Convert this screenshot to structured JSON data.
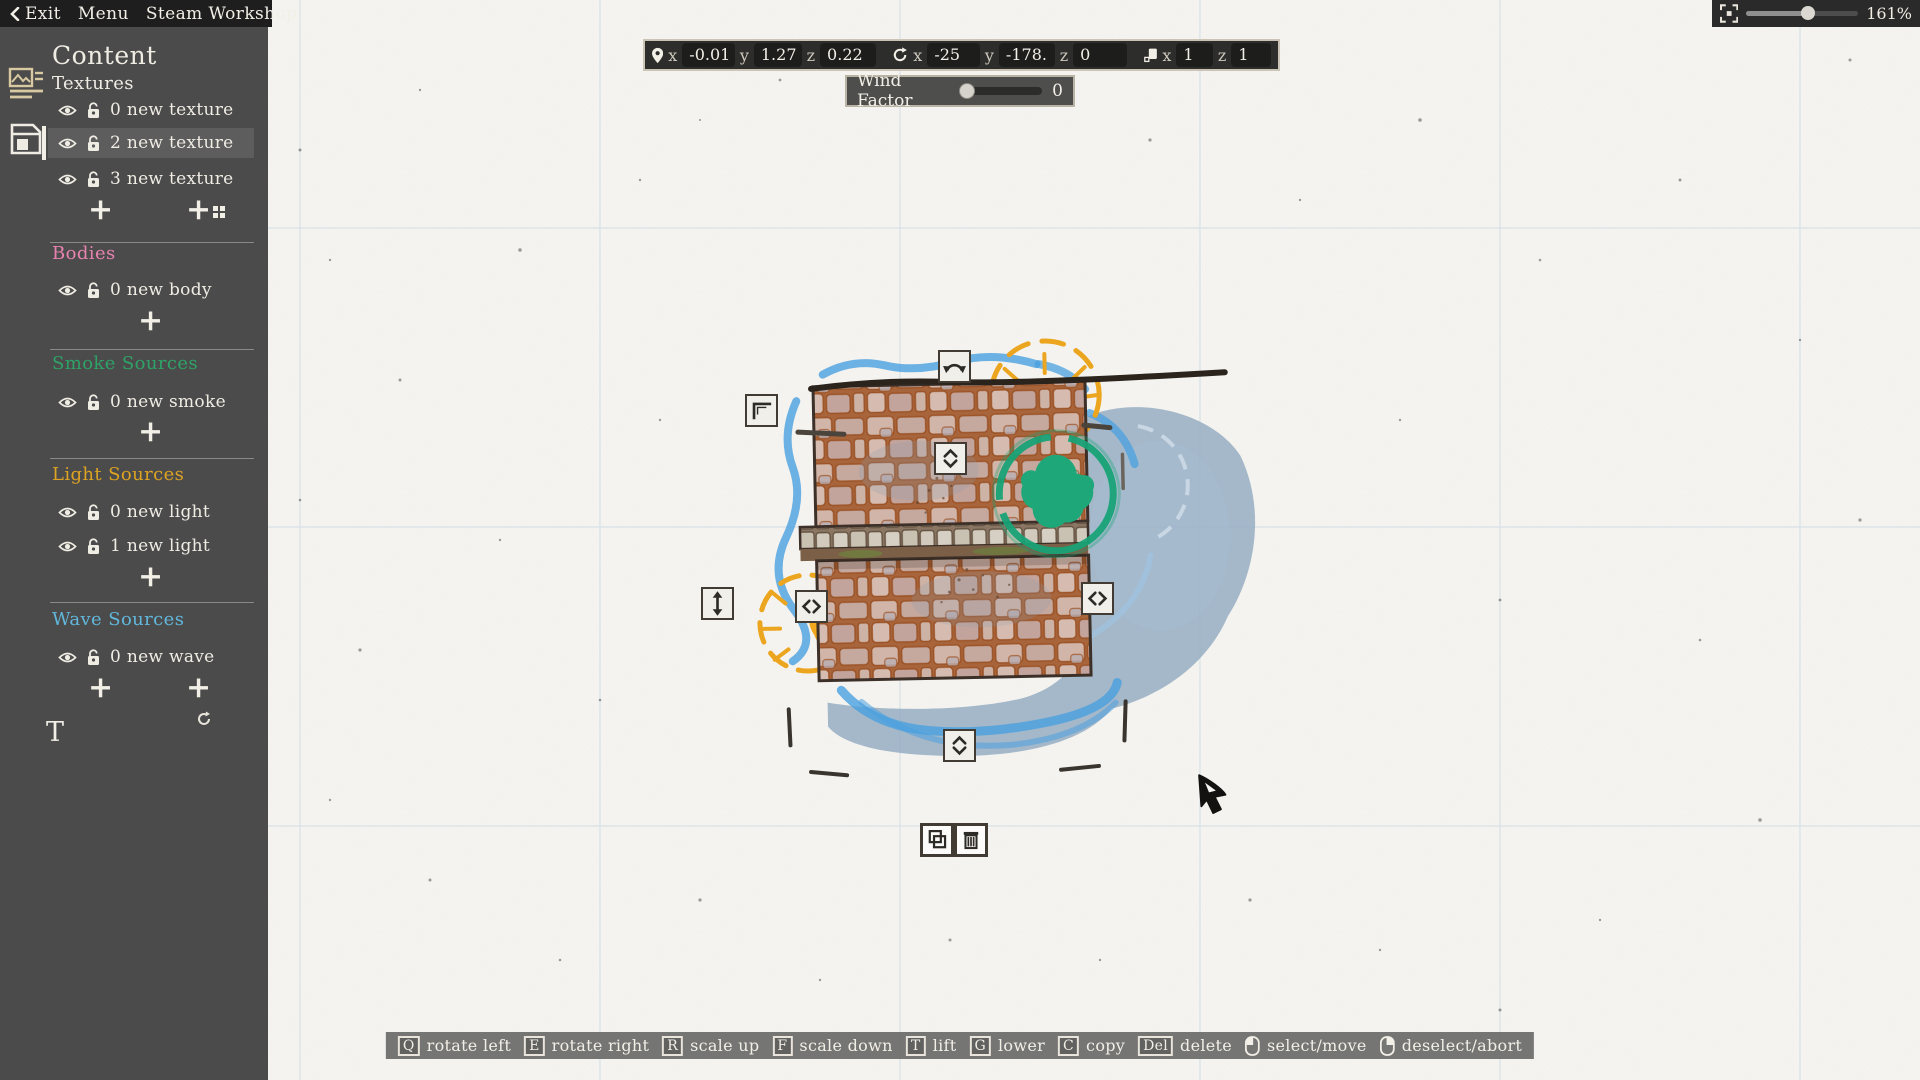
{
  "menu": {
    "exit": "Exit",
    "menu": "Menu",
    "workshop": "Steam Workshop"
  },
  "sidebar": {
    "title": "Content",
    "add_label": "+",
    "text_tool": "T",
    "sections": [
      {
        "label": "Textures",
        "color": "#efece4",
        "items": [
          {
            "label": "0 new texture",
            "selected": false
          },
          {
            "label": "2 new texture",
            "selected": true
          },
          {
            "label": "3 new texture",
            "selected": false
          }
        ]
      },
      {
        "label": "Bodies",
        "color": "#e783af",
        "items": [
          {
            "label": "0 new body",
            "selected": false
          }
        ]
      },
      {
        "label": "Smoke Sources",
        "color": "#2ea367",
        "items": [
          {
            "label": "0 new smoke",
            "selected": false
          }
        ]
      },
      {
        "label": "Light Sources",
        "color": "#dda322",
        "items": [
          {
            "label": "0 new light",
            "selected": false
          },
          {
            "label": "1 new light",
            "selected": false
          }
        ]
      },
      {
        "label": "Wave Sources",
        "color": "#61b7dc",
        "items": [
          {
            "label": "0 new wave",
            "selected": false
          }
        ]
      }
    ]
  },
  "transform_bar": {
    "axis": {
      "x": "x",
      "y": "y",
      "z": "z"
    },
    "position": {
      "x": "-0.01",
      "y": "1.27",
      "z": "0.22"
    },
    "rotation": {
      "x": "-25",
      "y": "-178.",
      "z": "0"
    },
    "scale": {
      "x": "1",
      "z": "1"
    }
  },
  "wind": {
    "label": "Wind Factor",
    "value": "0"
  },
  "zoom_control": {
    "value": "161%",
    "percent": 55
  },
  "hotkey_bar": [
    {
      "key": "Q",
      "label": "rotate left"
    },
    {
      "key": "E",
      "label": "rotate right"
    },
    {
      "key": "R",
      "label": "scale up"
    },
    {
      "key": "F",
      "label": "scale down"
    },
    {
      "key": "T",
      "label": "lift"
    },
    {
      "key": "G",
      "label": "lower"
    },
    {
      "key": "C",
      "label": "copy"
    },
    {
      "key": "Del",
      "label": "delete"
    },
    {
      "mouse": "left",
      "label": "select/move"
    },
    {
      "mouse": "right",
      "label": "deselect/abort"
    }
  ],
  "colors": {
    "sidebar_bg": "#4b4b4b",
    "menubar_bg": "#1e1e1e",
    "paper": "#f6f5f1",
    "bodies_accent": "#e783af",
    "smoke_accent": "#2ea367",
    "light_accent": "#dda322",
    "wave_accent": "#61b7dc",
    "tree_green": "#18a276",
    "light_source_orange": "#eca51e",
    "water_blue": "#4aa0e0",
    "shadow_blue": "#93abc1",
    "brick": "#c89a83",
    "mortar": "#a8643a"
  }
}
